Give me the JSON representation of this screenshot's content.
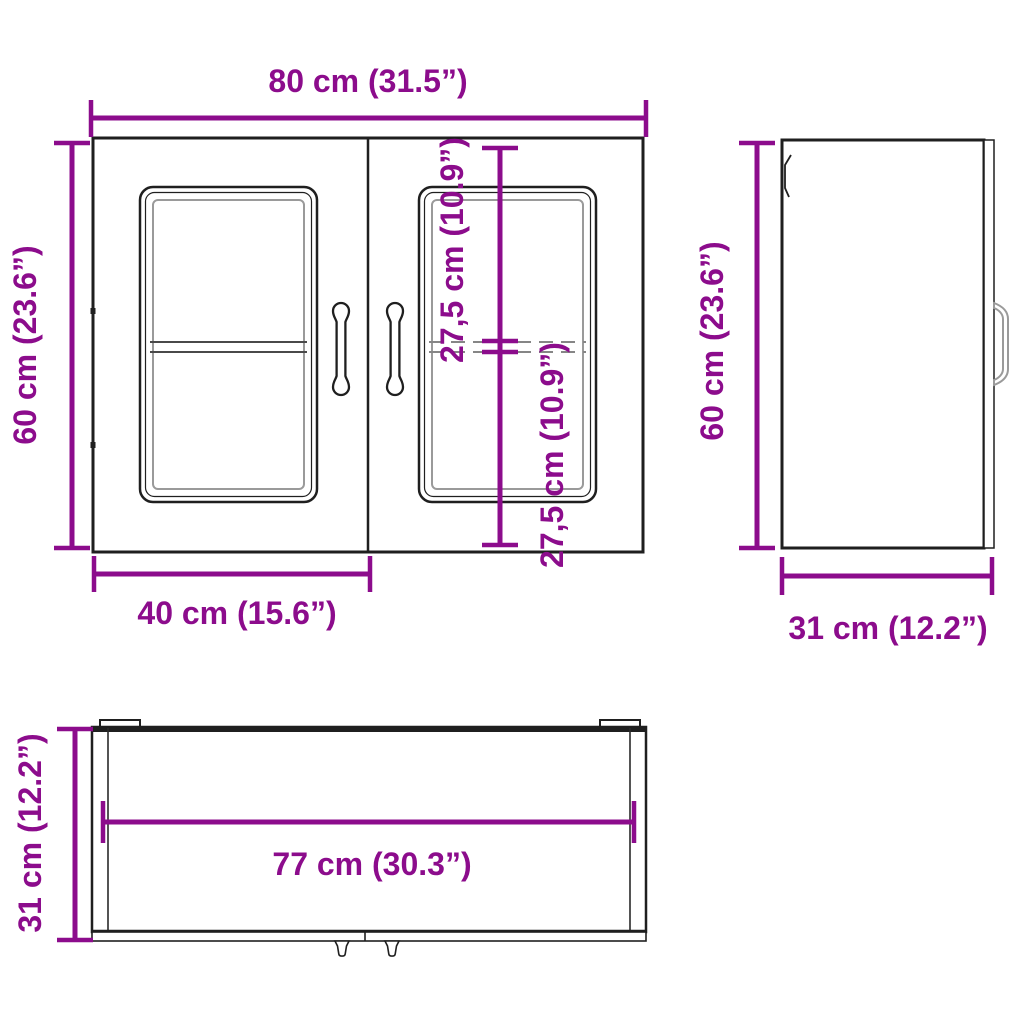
{
  "diagram_type": "furniture-dimension-drawing",
  "subject": "wall cabinet with two glass doors",
  "colors": {
    "dimension_accent": "#8c0c8c",
    "outline": "#1f1f1f",
    "glass_frame_gray": "#9a9a9a",
    "background": "#ffffff"
  },
  "front_view": {
    "width_label": "80 cm (31.5”)",
    "height_label": "60 cm (23.6”)",
    "door_width_label": "40 cm (15.6”)",
    "upper_section_label": "27,5 cm (10.9”)",
    "lower_section_label": "27,5 cm (10.9”)"
  },
  "side_view": {
    "height_label": "60 cm (23.6”)",
    "depth_label": "31 cm (12.2”)"
  },
  "top_view": {
    "inner_width_label": "77 cm (30.3”)",
    "depth_label": "31 cm (12.2”)"
  }
}
